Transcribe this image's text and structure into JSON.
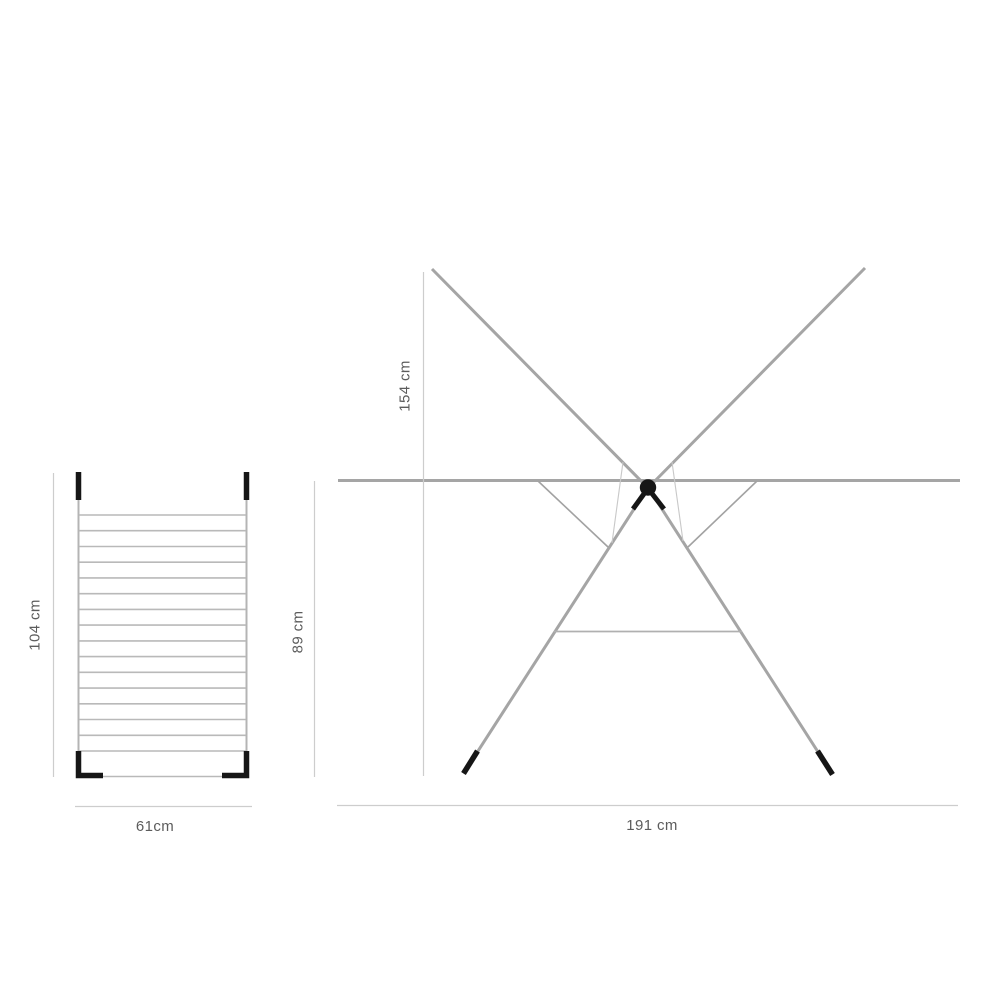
{
  "figure": {
    "type": "product-dimension-diagram",
    "views": {
      "top_view": {
        "height_label": "104 cm",
        "width_label": "61cm",
        "rung_count": 16
      },
      "side_view": {
        "overall_height_label": "154 cm",
        "frame_height_label": "89 cm",
        "width_label": "191 cm"
      }
    },
    "colors": {
      "structure_gray": "#a5a5a5",
      "rack_gray": "#b4b4b4",
      "wire_light_gray": "#c8c8c8",
      "dimension_line_gray": "#cdcdcd",
      "label_text_gray": "#5c5c5c",
      "accent_black": "#161616",
      "background": "#ffffff"
    }
  }
}
